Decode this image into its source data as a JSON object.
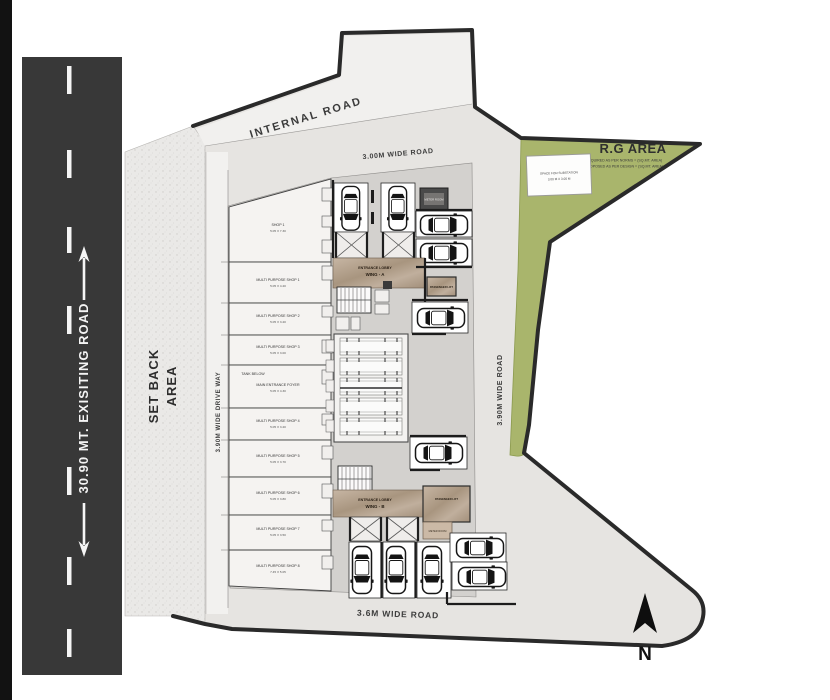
{
  "page": {
    "kind": "architectural ground floor site plan"
  },
  "roads": {
    "existing_label": "30.90 MT. EXISITING ROAD",
    "internal_label": "INTERNAL ROAD",
    "top_label": "3.00M WIDE ROAD",
    "right_label": "3.90M WIDE ROAD",
    "bottom_label": "3.6M WIDE ROAD",
    "driveway_label": "3.90M WIDE DRIVE WAY"
  },
  "zones": {
    "setback_line1": "SET BACK",
    "setback_line2": "AREA",
    "rg_title": "R.G AREA",
    "rg_note1": "REQUIRED AS PER NORMS = (SQ.MT. AREA)",
    "rg_note2": "PROPOSED AS PER DESIGN = (SQ.MT. AREA)",
    "substation_line1": "SPACE FOR SUBSTATION",
    "substation_line2": "3.00 M X 3.00 M"
  },
  "core": {
    "lobby_a_line1": "ENTRANCE LOBBY",
    "lobby_a_line2": "WING - A",
    "lobby_b_line1": "ENTRANCE LOBBY",
    "lobby_b_line2": "WING - B",
    "lift_a_label": "PASSENGER LIFT",
    "lift_b_label": "PASSENGER LIFT",
    "meter_label": "METER ROOM",
    "elect_label": "METER ROOM",
    "tank_note": "TANK BELOW"
  },
  "shops": [
    {
      "name": "SHOP 1",
      "dims": "5.05 X 7.30"
    },
    {
      "name": "MULTI PURPOSE SHOP 1",
      "dims": "5.05 X 4.20"
    },
    {
      "name": "MULTI PURPOSE SHOP 2",
      "dims": "5.05 X 3.20"
    },
    {
      "name": "MULTI PURPOSE SHOP 3",
      "dims": "5.05 X 3.00"
    },
    {
      "name": "MAIN ENTRANCE FOYER",
      "dims": "5.05 X 4.30"
    },
    {
      "name": "MULTI PURPOSE SHOP 4",
      "dims": "5.05 X 3.20"
    },
    {
      "name": "MULTI PURPOSE SHOP 5",
      "dims": "5.05 X 3.70"
    },
    {
      "name": "MULTI PURPOSE SHOP 6",
      "dims": "5.05 X 3.80"
    },
    {
      "name": "MULTI PURPOSE SHOP 7",
      "dims": "5.05 X 3.50"
    },
    {
      "name": "MULTI PURPOSE SHOP 8",
      "dims": "7.45 X 5.05"
    }
  ],
  "compass": {
    "north_label": "N"
  },
  "colors": {
    "asphalt": "#383838",
    "rg_green": "#a9b56c",
    "lobby_tan": "#b2a08d",
    "building_gray": "#d3d1ce",
    "boundary": "#2a2a2a"
  }
}
